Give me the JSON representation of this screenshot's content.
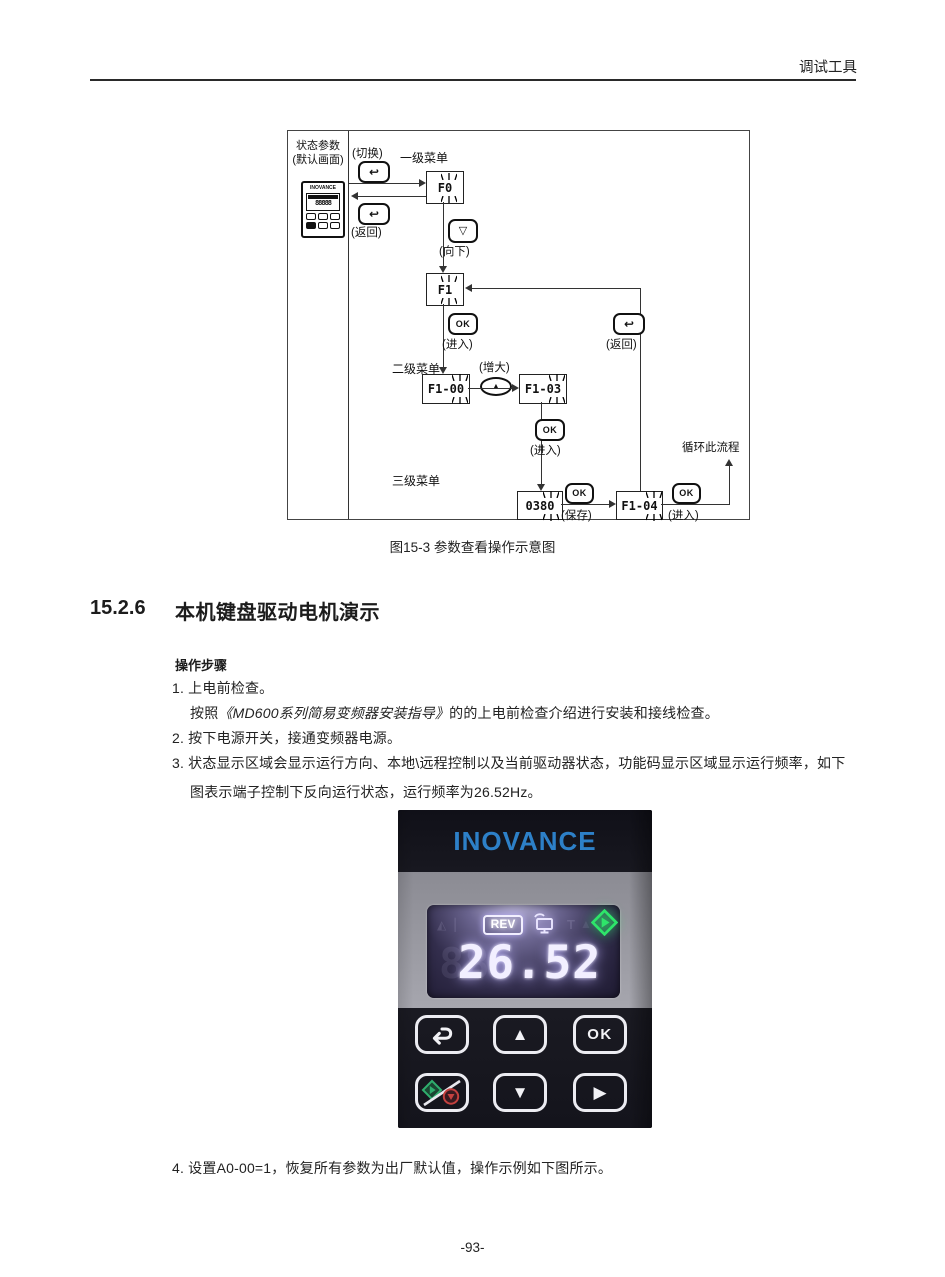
{
  "header": {
    "title": "调试工具"
  },
  "figure": {
    "caption": "图15-3 参数查看操作示意图",
    "panel": {
      "line1": "状态参数",
      "line2": "(默认画面)",
      "brand": "INOVANCE",
      "segments": "88888"
    },
    "labels": {
      "switch": "(切换)",
      "back": "(返回)",
      "menu1": "一级菜单",
      "down": "(向下)",
      "enter": "(进入)",
      "menu2": "二级菜单",
      "increase": "(增大)",
      "menu3": "三级菜单",
      "save": "(保存)",
      "loop": "循环此流程",
      "ok": "OK"
    },
    "nodes": {
      "f0": {
        "prefix": "F",
        "blink": "0"
      },
      "f1": {
        "prefix": "F",
        "blink": "1"
      },
      "f1_00": {
        "prefix": "F1-0",
        "blink": "0"
      },
      "f1_03": {
        "prefix": "F1-0",
        "blink": "3"
      },
      "n0380": {
        "prefix": "038",
        "blink": "0"
      },
      "f1_04": {
        "prefix": "F1-0",
        "blink": "4"
      }
    }
  },
  "icons": {
    "return": "↩",
    "up": "▲",
    "down_outline": "▽",
    "down": "▼",
    "right": "▶"
  },
  "section": {
    "number": "15.2.6",
    "title": "本机键盘驱动电机演示"
  },
  "steps": {
    "heading": "操作步骤",
    "s1": "1. 上电前检查。",
    "s1b_pre": "按照",
    "s1b_book": "《MD600系列简易变频器安装指导》",
    "s1b_post": "的的上电前检查介绍进行安装和接线检查。",
    "s2": "2. 按下电源开关，接通变频器电源。",
    "s3a": "3. 状态显示区域会显示运行方向、本地\\远程控制以及当前驱动器状态，功能码显示区域显示运行频率，如下",
    "s3b": "图表示端子控制下反向运行状态，运行频率为26.52Hz。",
    "s4": "4. 设置A0-00=1，恢复所有参数为出厂默认值，操作示例如下图所示。"
  },
  "photo": {
    "brand": "INOVANCE",
    "display": {
      "rev": "REV",
      "value": "26.52",
      "unlit": "88"
    },
    "keys": {
      "ok": "OK"
    }
  },
  "footer": {
    "page_number": "-93-"
  },
  "colors": {
    "accent_blue": "#2d80c8",
    "run_green": "#2ee56a",
    "stop_red": "#d04545",
    "lcd_glow": "#beb4ff"
  }
}
